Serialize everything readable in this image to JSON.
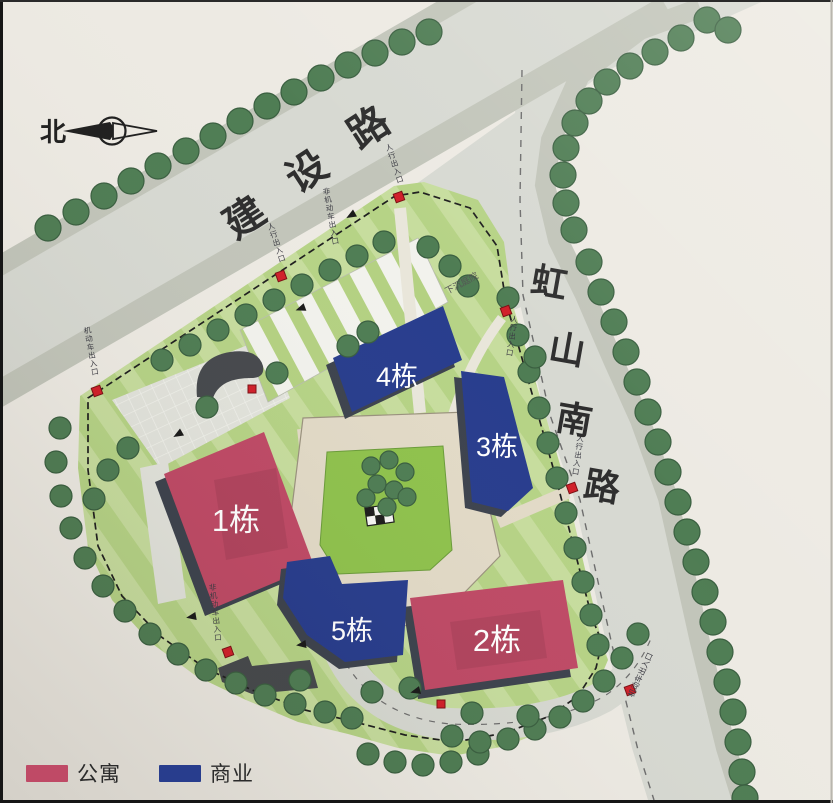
{
  "meta": {
    "width": 833,
    "height": 803
  },
  "colors": {
    "paper": "#edeae3",
    "road": "#d7d9d2",
    "sidewalk": "#c2c5ba",
    "site_green": "#b6d386",
    "site_green_light": "#c7dd9e",
    "lawn": "#8fc24d",
    "plaza": "#e2e3dc",
    "plaza_line": "#f1f2ec",
    "path": "#e2dac7",
    "path_edge": "#9a927e",
    "walk_light": "#e9e6da",
    "apartment": "#bf4a66",
    "commercial": "#283d8d",
    "shadow": "#3d434e",
    "ramp": "#46494d",
    "tree": "#4f7d54",
    "tree_edge": "#3a5f40",
    "marker": "#d1202a",
    "marker_edge": "#7c1014",
    "boundary": "#1f1f1f",
    "road_label": "#2e2e2e",
    "tiny_label": "#3c3c44",
    "white": "#ffffff",
    "lane_dash": "#6d6d6d",
    "frame": "#161616"
  },
  "north": {
    "label": "北"
  },
  "roads": [
    {
      "id": "jianshe-road",
      "name": "建设路",
      "rot": -33,
      "size": 40,
      "chars": [
        {
          "c": "建",
          "x": 252,
          "y": 229
        },
        {
          "c": "设",
          "x": 314,
          "y": 183
        },
        {
          "c": "路",
          "x": 376,
          "y": 139
        }
      ]
    },
    {
      "id": "hongshan-south-road",
      "name": "虹山南路",
      "rot": 10,
      "size": 36,
      "chars": [
        {
          "c": "虹",
          "x": 547,
          "y": 295
        },
        {
          "c": "山",
          "x": 565,
          "y": 362
        },
        {
          "c": "南",
          "x": 572,
          "y": 432
        },
        {
          "c": "路",
          "x": 600,
          "y": 499
        }
      ]
    }
  ],
  "buildings": [
    {
      "id": "1",
      "label": "1栋",
      "type": "apartment",
      "points": [
        [
          164,
          474
        ],
        [
          264,
          432
        ],
        [
          314,
          566
        ],
        [
          214,
          608
        ]
      ],
      "lx": 236,
      "ly": 531,
      "size": 31,
      "sdx": -9,
      "sdy": 8,
      "inner": [
        [
          214,
          480
        ],
        [
          276,
          468
        ],
        [
          288,
          548
        ],
        [
          226,
          560
        ]
      ]
    },
    {
      "id": "2",
      "label": "2栋",
      "type": "apartment",
      "points": [
        [
          410,
          598
        ],
        [
          563,
          580
        ],
        [
          578,
          668
        ],
        [
          425,
          690
        ]
      ],
      "lx": 497,
      "ly": 651,
      "size": 31,
      "sdx": -7,
      "sdy": 9,
      "inner": [
        [
          450,
          622
        ],
        [
          540,
          610
        ],
        [
          547,
          658
        ],
        [
          457,
          670
        ]
      ]
    },
    {
      "id": "3",
      "label": "3栋",
      "type": "commercial",
      "points": [
        [
          461,
          371
        ],
        [
          504,
          377
        ],
        [
          533,
          488
        ],
        [
          508,
          511
        ],
        [
          472,
          502
        ]
      ],
      "lx": 497,
      "ly": 456,
      "size": 27,
      "sdx": -7,
      "sdy": 6
    },
    {
      "id": "4",
      "label": "4栋",
      "type": "commercial",
      "points": [
        [
          333,
          358
        ],
        [
          443,
          306
        ],
        [
          462,
          360
        ],
        [
          352,
          412
        ]
      ],
      "lx": 397,
      "ly": 386,
      "size": 27,
      "sdx": -7,
      "sdy": 7
    },
    {
      "id": "5",
      "label": "5栋",
      "type": "commercial",
      "points": [
        [
          287,
          562
        ],
        [
          330,
          556
        ],
        [
          342,
          584
        ],
        [
          408,
          580
        ],
        [
          403,
          655
        ],
        [
          345,
          662
        ],
        [
          307,
          635
        ],
        [
          283,
          598
        ]
      ],
      "lx": 352,
      "ly": 640,
      "size": 27,
      "sdx": -6,
      "sdy": 7
    }
  ],
  "legend": {
    "items": [
      {
        "label": "公寓",
        "type": "apartment"
      },
      {
        "label": "商业",
        "type": "commercial"
      }
    ]
  },
  "entrances": [
    {
      "label": "人行出入口",
      "mx": 399,
      "my": 197,
      "tx": 390,
      "ty": 150,
      "rot": -18,
      "vertical": true
    },
    {
      "label": "人行出入口",
      "mx": 281,
      "my": 276,
      "tx": 272,
      "ty": 229,
      "rot": -18,
      "vertical": true
    },
    {
      "label": "机动车出入口",
      "mx": 97,
      "my": 391,
      "tx": 88,
      "ty": 333,
      "rot": -10,
      "vertical": true
    },
    {
      "label": "人行出入口",
      "mx": 506,
      "my": 311,
      "tx": 514,
      "ty": 322,
      "rot": 8,
      "vertical": true
    },
    {
      "label": "人行出入口",
      "mx": 572,
      "my": 488,
      "tx": 580,
      "ty": 441,
      "rot": 8,
      "vertical": true
    },
    {
      "label": "非机动车出入口",
      "mx": 228,
      "my": 652,
      "tx": 213,
      "ty": 590,
      "rot": -6,
      "vertical": true
    },
    {
      "label": "机动车出入口",
      "mx": 630,
      "my": 690,
      "tx": 643,
      "ty": 676,
      "rot": -65,
      "vertical": false
    }
  ],
  "plain_markers": [
    [
      441,
      704
    ],
    [
      252,
      389
    ]
  ],
  "annotations": [
    {
      "label": "下沉庭院",
      "x": 463,
      "y": 286,
      "rot": -28,
      "size": 9,
      "vertical": false
    },
    {
      "label": "非机动车出入口",
      "x": 327,
      "y": 194,
      "rot": -10,
      "size": 7.5,
      "vertical": true
    }
  ],
  "arrows": [
    [
      355,
      213,
      150
    ],
    [
      305,
      307,
      160
    ],
    [
      182,
      432,
      150
    ],
    [
      196,
      616,
      170
    ],
    [
      306,
      644,
      172
    ],
    [
      420,
      690,
      165
    ]
  ],
  "trees": {
    "r_road": 13,
    "r_site": 11,
    "r_lawn": 9,
    "jianshe_upper": [
      [
        48,
        228
      ],
      [
        76,
        212
      ],
      [
        104,
        196
      ],
      [
        131,
        181
      ],
      [
        158,
        166
      ],
      [
        186,
        151
      ],
      [
        213,
        136
      ],
      [
        240,
        121
      ],
      [
        267,
        106
      ],
      [
        294,
        92
      ],
      [
        321,
        78
      ],
      [
        348,
        65
      ],
      [
        375,
        53
      ],
      [
        402,
        42
      ],
      [
        429,
        32
      ]
    ],
    "corner_arc": [
      [
        707,
        20
      ],
      [
        728,
        30
      ],
      [
        681,
        38
      ],
      [
        655,
        52
      ],
      [
        630,
        66
      ],
      [
        607,
        82
      ],
      [
        589,
        101
      ],
      [
        575,
        123
      ],
      [
        566,
        148
      ],
      [
        563,
        175
      ],
      [
        566,
        203
      ],
      [
        574,
        230
      ]
    ],
    "hongshan_right": [
      [
        589,
        262
      ],
      [
        601,
        292
      ],
      [
        614,
        322
      ],
      [
        626,
        352
      ],
      [
        637,
        382
      ],
      [
        648,
        412
      ],
      [
        658,
        442
      ],
      [
        668,
        472
      ],
      [
        678,
        502
      ],
      [
        687,
        532
      ],
      [
        696,
        562
      ],
      [
        705,
        592
      ],
      [
        713,
        622
      ],
      [
        720,
        652
      ],
      [
        727,
        682
      ],
      [
        733,
        712
      ],
      [
        738,
        742
      ],
      [
        742,
        772
      ],
      [
        745,
        798
      ]
    ],
    "site_nw": [
      [
        162,
        360
      ],
      [
        190,
        345
      ],
      [
        218,
        330
      ],
      [
        246,
        315
      ],
      [
        274,
        300
      ],
      [
        302,
        285
      ],
      [
        330,
        270
      ],
      [
        357,
        256
      ],
      [
        384,
        242
      ]
    ],
    "site_east": [
      [
        508,
        298
      ],
      [
        518,
        335
      ],
      [
        529,
        372
      ],
      [
        539,
        408
      ],
      [
        548,
        443
      ],
      [
        557,
        478
      ],
      [
        566,
        513
      ],
      [
        575,
        548
      ],
      [
        583,
        582
      ],
      [
        591,
        615
      ],
      [
        598,
        645
      ]
    ],
    "site_sw": [
      [
        60,
        428
      ],
      [
        56,
        462
      ],
      [
        61,
        496
      ],
      [
        71,
        528
      ],
      [
        85,
        558
      ],
      [
        103,
        586
      ],
      [
        125,
        611
      ],
      [
        150,
        634
      ],
      [
        178,
        654
      ],
      [
        206,
        670
      ],
      [
        236,
        683
      ],
      [
        265,
        695
      ],
      [
        295,
        704
      ],
      [
        325,
        712
      ],
      [
        352,
        718
      ]
    ],
    "bottom_outer": [
      [
        368,
        754
      ],
      [
        395,
        762
      ],
      [
        423,
        765
      ],
      [
        451,
        762
      ],
      [
        478,
        754
      ],
      [
        452,
        736
      ],
      [
        480,
        742
      ],
      [
        508,
        739
      ],
      [
        535,
        729
      ],
      [
        560,
        717
      ],
      [
        583,
        701
      ],
      [
        604,
        681
      ],
      [
        622,
        658
      ],
      [
        638,
        634
      ]
    ],
    "interior": [
      [
        277,
        373
      ],
      [
        207,
        407
      ],
      [
        128,
        448
      ],
      [
        108,
        470
      ],
      [
        94,
        499
      ],
      [
        368,
        332
      ],
      [
        348,
        346
      ],
      [
        428,
        247
      ],
      [
        450,
        266
      ],
      [
        468,
        286
      ],
      [
        372,
        692
      ],
      [
        410,
        688
      ],
      [
        472,
        713
      ],
      [
        528,
        716
      ],
      [
        300,
        680
      ],
      [
        535,
        357
      ]
    ],
    "lawn_cluster": [
      [
        371,
        466
      ],
      [
        389,
        460
      ],
      [
        405,
        472
      ],
      [
        377,
        484
      ],
      [
        394,
        490
      ],
      [
        366,
        498
      ],
      [
        407,
        497
      ],
      [
        387,
        507
      ]
    ]
  },
  "geometry": {
    "road_jianshe": [
      [
        -167,
        362
      ],
      [
        612,
        -88
      ],
      [
        667,
        7
      ],
      [
        -112,
        458
      ]
    ],
    "sidewalk_jianshe_lower": [
      [
        -112,
        458
      ],
      [
        667,
        8
      ]
    ],
    "sidewalk_jianshe_upper": [
      [
        -167,
        362
      ],
      [
        612,
        -88
      ]
    ],
    "road_hongshan": [
      [
        516,
        60
      ],
      [
        514,
        180
      ],
      [
        517,
        290
      ],
      [
        544,
        412
      ],
      [
        574,
        498
      ],
      [
        606,
        642
      ],
      [
        632,
        748
      ],
      [
        648,
        800
      ],
      [
        742,
        800
      ],
      [
        726,
        748
      ],
      [
        700,
        642
      ],
      [
        668,
        498
      ],
      [
        640,
        420
      ],
      [
        613,
        360
      ],
      [
        585,
        295
      ],
      [
        558,
        240
      ],
      [
        545,
        185
      ],
      [
        551,
        140
      ],
      [
        580,
        75
      ],
      [
        640,
        30
      ],
      [
        700,
        8
      ],
      [
        560,
        -30
      ],
      [
        516,
        -30
      ]
    ],
    "junction": "M 380,210 L 700,-20 L 810,-20 Q 700,30 640,55 Q 580,80 556,120 Q 543,155 548,200 L 566,290 L 508,312 Q 500,230 452,206 Z",
    "bottom_road": "M 340,652 Q 370,716 450,724 Q 545,728 603,697 Q 636,676 652,636",
    "site": [
      [
        80,
        396
      ],
      [
        394,
        186
      ],
      [
        424,
        182
      ],
      [
        478,
        200
      ],
      [
        504,
        242
      ],
      [
        512,
        302
      ],
      [
        564,
        478
      ],
      [
        600,
        634
      ],
      [
        608,
        660
      ],
      [
        596,
        688
      ],
      [
        585,
        710
      ],
      [
        552,
        728
      ],
      [
        506,
        746
      ],
      [
        452,
        756
      ],
      [
        398,
        748
      ],
      [
        348,
        734
      ],
      [
        298,
        722
      ],
      [
        246,
        700
      ],
      [
        196,
        676
      ],
      [
        150,
        642
      ],
      [
        112,
        600
      ],
      [
        88,
        548
      ],
      [
        78,
        468
      ]
    ],
    "boundary": [
      [
        88,
        398
      ],
      [
        395,
        196
      ],
      [
        420,
        192
      ],
      [
        470,
        208
      ],
      [
        497,
        246
      ],
      [
        506,
        302
      ],
      [
        556,
        478
      ],
      [
        592,
        618
      ],
      [
        602,
        642
      ],
      [
        596,
        668
      ],
      [
        578,
        696
      ],
      [
        550,
        716
      ],
      [
        505,
        733
      ],
      [
        455,
        742
      ],
      [
        405,
        735
      ],
      [
        355,
        722
      ],
      [
        305,
        710
      ],
      [
        252,
        690
      ],
      [
        205,
        668
      ],
      [
        160,
        636
      ],
      [
        122,
        596
      ],
      [
        98,
        546
      ],
      [
        88,
        470
      ]
    ],
    "nw_plaza": [
      [
        112,
        400
      ],
      [
        265,
        338
      ],
      [
        290,
        398
      ],
      [
        160,
        468
      ]
    ],
    "parking": [
      [
        240,
        330
      ],
      [
        418,
        238
      ],
      [
        448,
        302
      ],
      [
        268,
        402
      ]
    ],
    "ring": [
      [
        303,
        418
      ],
      [
        468,
        412
      ],
      [
        500,
        556
      ],
      [
        434,
        624
      ],
      [
        324,
        630
      ],
      [
        287,
        548
      ]
    ],
    "lawn": [
      [
        327,
        452
      ],
      [
        443,
        446
      ],
      [
        452,
        550
      ],
      [
        430,
        570
      ],
      [
        338,
        574
      ],
      [
        320,
        545
      ]
    ],
    "west_walk": [
      [
        140,
        468
      ],
      [
        168,
        462
      ],
      [
        186,
        598
      ],
      [
        158,
        604
      ]
    ],
    "ramp_nw": "M 197,397 Q 193,358 230,352 Q 258,348 263,366 Q 265,378 251,378 Q 220,378 213,398 Z",
    "ramp_s": [
      [
        218,
        668
      ],
      [
        248,
        656
      ],
      [
        252,
        666
      ],
      [
        310,
        660
      ],
      [
        318,
        688
      ],
      [
        252,
        694
      ],
      [
        222,
        682
      ]
    ],
    "walks": [
      {
        "d": "M 400,208 L 420,413",
        "w": 12,
        "c": "walk_light"
      },
      {
        "d": "M 452,418 Q 470,360 502,318",
        "w": 10,
        "c": "walk_light"
      },
      {
        "d": "M 310,428 Q 320,520 340,614",
        "w": 26,
        "c": "path"
      },
      {
        "d": "M 377,520 Q 380,580 392,652",
        "w": 18,
        "c": "path"
      },
      {
        "d": "M 498,522 L 568,492",
        "w": 13,
        "c": "path"
      }
    ],
    "lane_dash_hongshan": [
      [
        522,
        70
      ],
      [
        520,
        200
      ],
      [
        523,
        295
      ],
      [
        550,
        415
      ],
      [
        580,
        500
      ],
      [
        612,
        645
      ],
      [
        638,
        750
      ],
      [
        654,
        800
      ]
    ],
    "checker": {
      "x": 366,
      "y": 506,
      "w": 27,
      "h": 18,
      "rot": -8
    }
  }
}
